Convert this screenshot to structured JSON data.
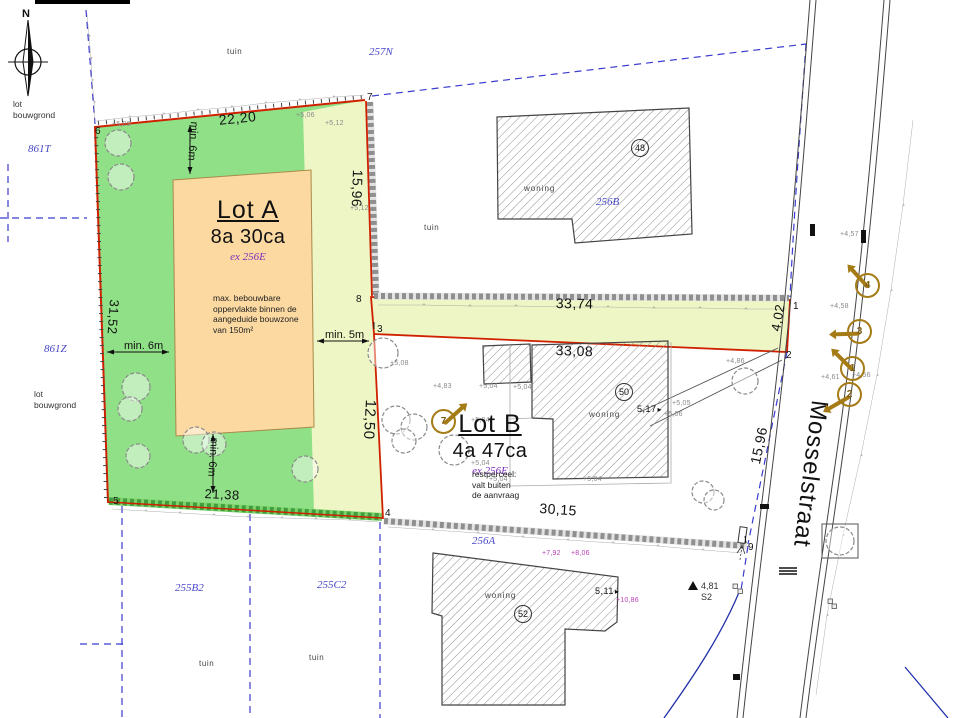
{
  "colors": {
    "lot_green": "#90e087",
    "zone_pale": "#eef6c6",
    "bouwzone_orange": "#fbd9a1",
    "boundary_red": "#d02000",
    "cadastral_blue": "#3b3bd0",
    "origin_purple": "#7b2dbb",
    "photo_gold": "#a57b16",
    "roof_magenta": "#b63db6"
  },
  "compass": {
    "label": "N"
  },
  "street": {
    "name": "Mosselstraat"
  },
  "benchmark": {
    "value": "4,81",
    "code": "S2"
  },
  "lot_a": {
    "title": "Lot A",
    "area": "8a 30ca",
    "origin": "ex 256E",
    "bouwzone_note": "max. bebouwbare\noppervlakte binnen de\naangeduide bouwzone\nvan 150m²"
  },
  "lot_b": {
    "title": "Lot B",
    "area": "4a 47ca",
    "origin": "ex 256E",
    "note": "restperceel:\nvalt buiten\nde aanvraag"
  },
  "corner_notes": [
    {
      "text": "lot\nbouwgrond",
      "x": 13,
      "y": 99
    },
    {
      "text": "lot\nbouwgrond",
      "x": 34,
      "y": 389
    }
  ],
  "measurements": [
    {
      "text": "22,20",
      "x": 218,
      "y": 112,
      "rot": -6
    },
    {
      "text": "15,96",
      "x": 366,
      "y": 170,
      "rot": 92
    },
    {
      "text": "31,52",
      "x": 121,
      "y": 300,
      "rot": 94,
      "fs": 13
    },
    {
      "text": "21,38",
      "x": 205,
      "y": 487,
      "rot": 3,
      "fs": 13
    },
    {
      "text": "12,50",
      "x": 379,
      "y": 400,
      "rot": 93,
      "fs": 15
    },
    {
      "text": "33,74",
      "x": 556,
      "y": 295,
      "rot": 1
    },
    {
      "text": "4,02",
      "x": 769,
      "y": 330,
      "rot": -80,
      "fs": 13
    },
    {
      "text": "33,08",
      "x": 556,
      "y": 342,
      "rot": 2
    },
    {
      "text": "30,15",
      "x": 540,
      "y": 500,
      "rot": 4
    },
    {
      "text": "15,96",
      "x": 747,
      "y": 462,
      "rot": -78
    },
    {
      "text": "5,17",
      "x": 637,
      "y": 404,
      "fs": 9,
      "cls": "dim-arrow-right"
    },
    {
      "text": "5,11",
      "x": 595,
      "y": 586,
      "fs": 9,
      "cls": "dim-arrow-right"
    }
  ],
  "setbacks": [
    {
      "text": "min. 6m",
      "x": 200,
      "y": 122,
      "rot": 94
    },
    {
      "text": "min. 6m",
      "x": 124,
      "y": 340
    },
    {
      "text": "min. 5m",
      "x": 325,
      "y": 329
    },
    {
      "text": "min. 6m",
      "x": 220,
      "y": 438,
      "rot": 94
    }
  ],
  "parcels": [
    {
      "text": "861T",
      "x": 28,
      "y": 143
    },
    {
      "text": "861Z",
      "x": 44,
      "y": 343
    },
    {
      "text": "257N",
      "x": 369,
      "y": 46
    },
    {
      "text": "256B",
      "x": 596,
      "y": 196
    },
    {
      "text": "256A",
      "x": 472,
      "y": 535
    },
    {
      "text": "255B2",
      "x": 175,
      "y": 582
    },
    {
      "text": "255C2",
      "x": 317,
      "y": 579
    }
  ],
  "area_labels": [
    {
      "text": "tuin",
      "x": 227,
      "y": 47
    },
    {
      "text": "tuin",
      "x": 424,
      "y": 223
    },
    {
      "text": "tuin",
      "x": 199,
      "y": 659
    },
    {
      "text": "tuin",
      "x": 309,
      "y": 653
    }
  ],
  "building_labels": [
    {
      "text": "woning",
      "x": 524,
      "y": 184
    },
    {
      "text": "woning",
      "x": 589,
      "y": 410
    },
    {
      "text": "woning",
      "x": 485,
      "y": 591
    }
  ],
  "house_numbers": [
    {
      "text": "48",
      "x": 631,
      "y": 139
    },
    {
      "text": "50",
      "x": 615,
      "y": 383
    },
    {
      "text": "52",
      "x": 514,
      "y": 605
    }
  ],
  "survey_points": [
    {
      "text": "1",
      "x": 793,
      "y": 301
    },
    {
      "text": "2",
      "x": 786,
      "y": 350
    },
    {
      "text": "3",
      "x": 377,
      "y": 324
    },
    {
      "text": "4",
      "x": 385,
      "y": 508
    },
    {
      "text": "5",
      "x": 113,
      "y": 496
    },
    {
      "text": "6",
      "x": 95,
      "y": 126
    },
    {
      "text": "7",
      "x": 367,
      "y": 92
    },
    {
      "text": "8",
      "x": 356,
      "y": 294
    },
    {
      "text": "9",
      "x": 748,
      "y": 542
    }
  ],
  "elevations": [
    {
      "text": "+5,09",
      "x": 112,
      "y": 121
    },
    {
      "text": "+5,06",
      "x": 296,
      "y": 112
    },
    {
      "text": "+5,12",
      "x": 325,
      "y": 120
    },
    {
      "text": "+5,12",
      "x": 350,
      "y": 205
    },
    {
      "text": "+5,08",
      "x": 390,
      "y": 360
    },
    {
      "text": "+4,83",
      "x": 433,
      "y": 383
    },
    {
      "text": "+5,04",
      "x": 479,
      "y": 383
    },
    {
      "text": "+5,04",
      "x": 513,
      "y": 384
    },
    {
      "text": "+5,04",
      "x": 471,
      "y": 417
    },
    {
      "text": "+5,04",
      "x": 471,
      "y": 460
    },
    {
      "text": "+5,04",
      "x": 489,
      "y": 476
    },
    {
      "text": "+5,04",
      "x": 583,
      "y": 476
    },
    {
      "text": "+5,05",
      "x": 672,
      "y": 400
    },
    {
      "text": "+5,06",
      "x": 664,
      "y": 411
    },
    {
      "text": "+4,86",
      "x": 726,
      "y": 358
    },
    {
      "text": "+4,57",
      "x": 840,
      "y": 231
    },
    {
      "text": "+4,58",
      "x": 830,
      "y": 303
    },
    {
      "text": "+4,61",
      "x": 821,
      "y": 374
    },
    {
      "text": "+4,56",
      "x": 852,
      "y": 372
    },
    {
      "text": "+7,92",
      "x": 542,
      "y": 550,
      "cls": "magenta"
    },
    {
      "text": "+8,06",
      "x": 571,
      "y": 550,
      "cls": "magenta"
    },
    {
      "text": "+10,86",
      "x": 616,
      "y": 597,
      "cls": "magenta"
    }
  ],
  "photo_points": [
    {
      "n": "4",
      "x": 855,
      "y": 273,
      "arrow": -132
    },
    {
      "n": "3",
      "x": 847,
      "y": 319,
      "arrow": 178
    },
    {
      "n": "1",
      "x": 840,
      "y": 356,
      "arrow": -135
    },
    {
      "n": "2",
      "x": 837,
      "y": 382,
      "arrow": 150
    },
    {
      "n": "7",
      "x": 431,
      "y": 409,
      "arrow": -42
    }
  ]
}
